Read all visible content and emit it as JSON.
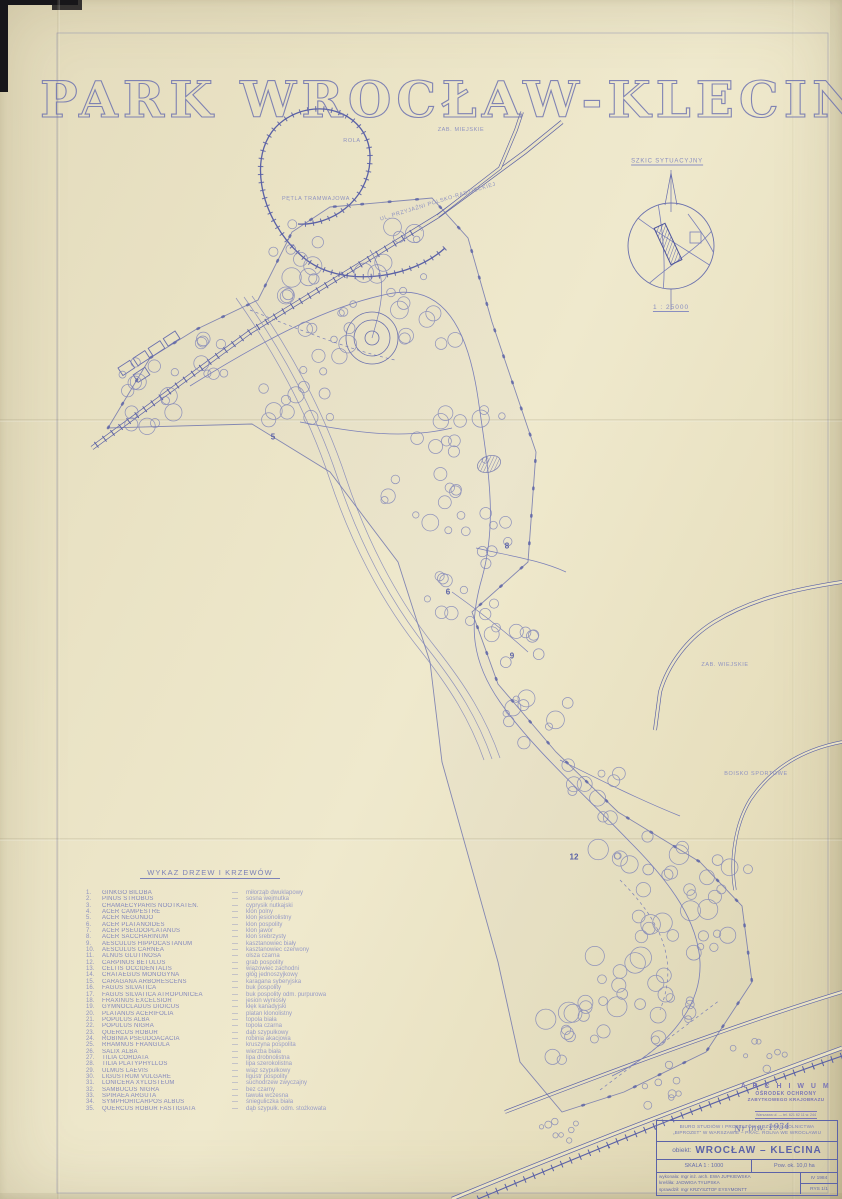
{
  "page": {
    "title": "PARK WROCŁAW-KLECINA"
  },
  "inset": {
    "title": "SZKIC SYTUACYJNY",
    "scale": "1 : 25000"
  },
  "map": {
    "labels": [
      {
        "text": "ROLA",
        "x": 352,
        "y": 141,
        "rotate": 0
      },
      {
        "text": "ZAB. MIEJSKIE",
        "x": 461,
        "y": 130,
        "rotate": 0
      },
      {
        "text": "PĘTLA TRAMWAJOWA",
        "x": 316,
        "y": 199,
        "rotate": 0
      },
      {
        "text": "UL. PRZYJAŹNI POLSKO-RADZIECKIEJ",
        "x": 438,
        "y": 202,
        "rotate": -17
      },
      {
        "text": "ZAB. WIEJSKIE",
        "x": 725,
        "y": 665,
        "rotate": 0
      },
      {
        "text": "BOISKO SPORTOWE",
        "x": 756,
        "y": 774,
        "rotate": 0
      }
    ],
    "markers": [
      {
        "label": "5",
        "x": 273,
        "y": 437
      },
      {
        "label": "6",
        "x": 448,
        "y": 592
      },
      {
        "label": "8",
        "x": 507,
        "y": 546
      },
      {
        "label": "9",
        "x": 512,
        "y": 656
      },
      {
        "label": "12",
        "x": 574,
        "y": 857
      }
    ]
  },
  "legend": {
    "heading": "WYKAZ DRZEW I KRZEWÓW",
    "separator": "—",
    "entries": [
      {
        "no": "1.",
        "latin": "GINKGO BILOBA",
        "polish": "miłorząb dwuklapowy"
      },
      {
        "no": "2.",
        "latin": "PINUS STROBUS",
        "polish": "sosna wejmutka"
      },
      {
        "no": "3.",
        "latin": "CHAMAECYPARIS NOOTKATEN.",
        "polish": "cyprysik nutkajski"
      },
      {
        "no": "4.",
        "latin": "ACER CAMPESTRE",
        "polish": "klon polny"
      },
      {
        "no": "5.",
        "latin": "ACER NEGUNDO",
        "polish": "klon jesionolistny"
      },
      {
        "no": "6.",
        "latin": "ACER PLATANOIDES",
        "polish": "klon pospolity"
      },
      {
        "no": "7.",
        "latin": "ACER PSEUDOPLATANUS",
        "polish": "klon jawor"
      },
      {
        "no": "8.",
        "latin": "ACER SACCHARINUM",
        "polish": "klon srebrzysty"
      },
      {
        "no": "9.",
        "latin": "AESCULUS HIPPOCASTANUM",
        "polish": "kasztanowiec biały"
      },
      {
        "no": "10.",
        "latin": "AESCULUS CARNEA",
        "polish": "kasztanowiec czerwony"
      },
      {
        "no": "11.",
        "latin": "ALNUS GLUTINOSA",
        "polish": "olsza czarna"
      },
      {
        "no": "12.",
        "latin": "CARPINUS BETULUS",
        "polish": "grab pospolity"
      },
      {
        "no": "13.",
        "latin": "CELTIS OCCIDENTALIS",
        "polish": "wiązowiec zachodni"
      },
      {
        "no": "14.",
        "latin": "CRATAEGUS MONOGYNA",
        "polish": "głóg jednoszyjkowy"
      },
      {
        "no": "15.",
        "latin": "CARAGANA ARBORESCENS",
        "polish": "karagana syberyjska"
      },
      {
        "no": "16.",
        "latin": "FAGUS SILVATICA",
        "polish": "buk pospolity"
      },
      {
        "no": "17.",
        "latin": "FAGUS SILVATICA ATROPUNICEA",
        "polish": "buk pospolity odm. purpurowa"
      },
      {
        "no": "18.",
        "latin": "FRAXINUS EXCELSIOR",
        "polish": "jesion wyniosły"
      },
      {
        "no": "19.",
        "latin": "GYMNOCLADUS DIOICUS",
        "polish": "kłęk kanadyjski"
      },
      {
        "no": "20.",
        "latin": "PLATANUS ACERIFOLIA",
        "polish": "platan klonolistny"
      },
      {
        "no": "21.",
        "latin": "POPULUS ALBA",
        "polish": "topola biała"
      },
      {
        "no": "22.",
        "latin": "POPULUS NIGRA",
        "polish": "topola czarna"
      },
      {
        "no": "23.",
        "latin": "QUERCUS ROBUR",
        "polish": "dąb szypułkowy"
      },
      {
        "no": "24.",
        "latin": "ROBINIA PSEUDOACACIA",
        "polish": "robinia akacjowa"
      },
      {
        "no": "25.",
        "latin": "RHAMNUS FRANGULA",
        "polish": "kruszyna pospolita"
      },
      {
        "no": "26.",
        "latin": "SALIX ALBA",
        "polish": "wierzba biała"
      },
      {
        "no": "27.",
        "latin": "TILIA CORDATA",
        "polish": "lipa drobnolistna"
      },
      {
        "no": "28.",
        "latin": "TILIA PLATYPHYLLOS",
        "polish": "lipa szerokolistna"
      },
      {
        "no": "29.",
        "latin": "ULMUS LAEVIS",
        "polish": "wiąz szypułkowy"
      },
      {
        "no": "30.",
        "latin": "LIGUSTRUM VULGARE",
        "polish": "ligustr pospolity"
      },
      {
        "no": "31.",
        "latin": "LONICERA XYLOSTEUM",
        "polish": "suchodrzew zwyczajny"
      },
      {
        "no": "32.",
        "latin": "SAMBUCUS NIGRA",
        "polish": "bez czarny"
      },
      {
        "no": "33.",
        "latin": "SPIRAEA ARGUTA",
        "polish": "tawuła wczesna"
      },
      {
        "no": "34.",
        "latin": "SYMPHORICARPOS ALBUS",
        "polish": "śnieguliczka biała"
      },
      {
        "no": "35.",
        "latin": "QUERCUS ROBUR FASTIGIATA",
        "polish": "dąb szypułk. odm. stożkowata"
      }
    ]
  },
  "stamp": {
    "line1": "A R C H I W U M",
    "line2": "OŚRODEK OCHRONY",
    "line3": "ZABYTKOWEGO KRAJOBRAZU",
    "line4": "Warszawa ul. — tel. 621 62 11 w. 244",
    "handwritten": "Nr inw. 1934"
  },
  "titleblock": {
    "org_line1": "BIURO STUDIÓW I PROJEKTÓW ROZWOJU ROLNICTWA",
    "org_line2": "„BIPROZET” W WARSZAWIE – PRAC. ROLNA WE WROCŁAWIU",
    "object_label": "obiekt:",
    "object_value": "WROCŁAW – KLECINA",
    "scale": "SKALA 1 : 1000",
    "area": "Pow. ok. 10,0 ha",
    "made_by": "wykonała: mgr inż. arch. EWA JUPKIEWSKA",
    "date": "IV 1984",
    "drawn_by": "kreśliła: JADWIGA TYLIPSKA",
    "checked_by": "sprawdził: mgr KRZYSZTOF EYSYMONTT",
    "drawing_no": "RYS 1/1"
  },
  "colors": {
    "ink": "#5a61a6",
    "ink_light": "#7b80b8",
    "paper": "#eae3c4"
  }
}
